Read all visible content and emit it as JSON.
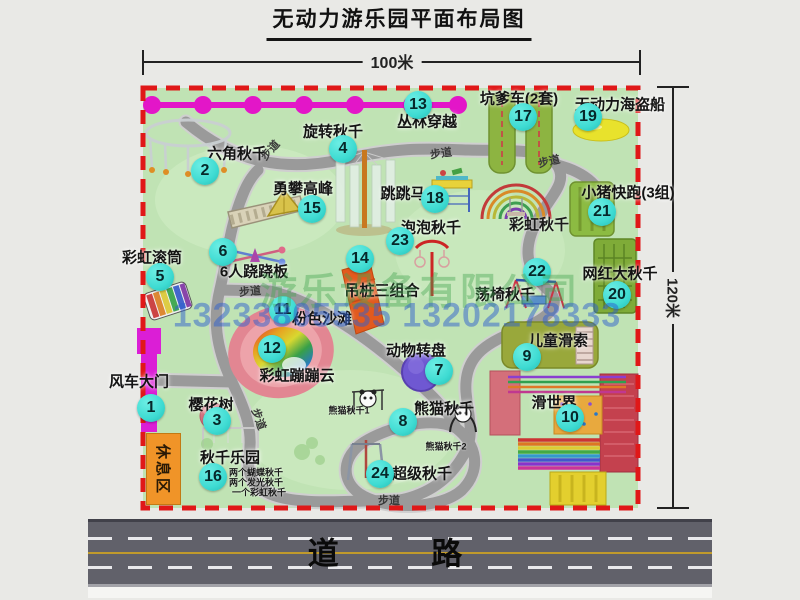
{
  "title": "无动力游乐园平面布局图",
  "dimensions": {
    "width": "100米",
    "height": "120米"
  },
  "road": {
    "label": "道 路"
  },
  "watermark": {
    "company": "游乐设备有限公司",
    "phone": "13233805535 13202178333"
  },
  "rest_area": "休息区",
  "colors": {
    "map_green": "#c0e3b4",
    "border_red": "#e01818",
    "badge_cyan": "#3edbd2",
    "chain_magenta": "#e316c8",
    "gate_magenta": "#db1ed6",
    "rest_orange": "#f09428",
    "road_gray": "#61616a",
    "path_gray": "#9a9a9a"
  },
  "attractions": [
    {
      "num": "1",
      "label": "风车大门",
      "lx": 139,
      "ly": 381,
      "bx": 151,
      "by": 408
    },
    {
      "num": "2",
      "label": "六角秋千",
      "lx": 237,
      "ly": 153,
      "bx": 205,
      "by": 171
    },
    {
      "num": "3",
      "label": "樱花树",
      "lx": 211,
      "ly": 404,
      "bx": 217,
      "by": 421
    },
    {
      "num": "4",
      "label": "旋转秋千",
      "lx": 333,
      "ly": 131,
      "bx": 343,
      "by": 149
    },
    {
      "num": "5",
      "label": "彩虹滚筒",
      "lx": 152,
      "ly": 257,
      "bx": 160,
      "by": 277
    },
    {
      "num": "6",
      "label": "6人跷跷板",
      "lx": 254,
      "ly": 271,
      "bx": 223,
      "by": 252
    },
    {
      "num": "7",
      "label": "动物转盘",
      "lx": 416,
      "ly": 350,
      "bx": 439,
      "by": 371
    },
    {
      "num": "8",
      "label": "熊猫秋千",
      "lx": 444,
      "ly": 408,
      "bx": 403,
      "by": 422
    },
    {
      "num": "9",
      "label": "儿童滑索",
      "lx": 558,
      "ly": 340,
      "bx": 527,
      "by": 357
    },
    {
      "num": "10",
      "label": "滑世界",
      "lx": 554,
      "ly": 402,
      "bx": 570,
      "by": 418
    },
    {
      "num": "11",
      "label": "粉色沙滩",
      "lx": 322,
      "ly": 318,
      "bx": 283,
      "by": 310
    },
    {
      "num": "12",
      "label": "彩虹蹦蹦云",
      "lx": 297,
      "ly": 375,
      "bx": 272,
      "by": 349
    },
    {
      "num": "13",
      "label": "丛林穿越",
      "lx": 427,
      "ly": 121,
      "bx": 418,
      "by": 105
    },
    {
      "num": "14",
      "label": "吊桩三组合",
      "lx": 382,
      "ly": 290,
      "bx": 360,
      "by": 259
    },
    {
      "num": "15",
      "label": "勇攀高峰",
      "lx": 303,
      "ly": 188,
      "bx": 312,
      "by": 209
    },
    {
      "num": "16",
      "label": "秋千乐园",
      "lx": 230,
      "ly": 457,
      "bx": 213,
      "by": 477
    },
    {
      "num": "17",
      "label": "坑爹车(2套)",
      "lx": 519,
      "ly": 98,
      "bx": 523,
      "by": 117
    },
    {
      "num": "18",
      "label": "跳跳马",
      "lx": 403,
      "ly": 193,
      "bx": 435,
      "by": 199
    },
    {
      "num": "19",
      "label": "无动力海盗船",
      "lx": 620,
      "ly": 104,
      "bx": 588,
      "by": 117
    },
    {
      "num": "20",
      "label": "网红大秋千",
      "lx": 620,
      "ly": 273,
      "bx": 617,
      "by": 295
    },
    {
      "num": "21",
      "label": "小猪快跑(3组)",
      "lx": 628,
      "ly": 192,
      "bx": 602,
      "by": 212
    },
    {
      "num": "22",
      "label": "荡椅秋千",
      "lx": 505,
      "ly": 294,
      "bx": 537,
      "by": 272
    },
    {
      "num": "23",
      "label": "泡泡秋千",
      "lx": 431,
      "ly": 227,
      "bx": 400,
      "by": 241
    },
    {
      "num": "24",
      "label": "超级秋千",
      "lx": 422,
      "ly": 473,
      "bx": 380,
      "by": 474
    }
  ],
  "small_labels": [
    {
      "text": "彩虹秋千",
      "x": 539,
      "y": 224,
      "size": 15
    },
    {
      "text": "熊猫秋千1",
      "x": 349,
      "y": 410,
      "size": 9
    },
    {
      "text": "熊猫秋千2",
      "x": 446,
      "y": 446,
      "size": 9
    },
    {
      "text": "两个蝴蝶秋千",
      "x": 256,
      "y": 472,
      "size": 9
    },
    {
      "text": "两个发光秋千",
      "x": 256,
      "y": 482,
      "size": 9
    },
    {
      "text": "一个彩虹秋千",
      "x": 259,
      "y": 492,
      "size": 9
    }
  ],
  "path_labels": [
    {
      "text": "步道",
      "x": 270,
      "y": 150,
      "rot": -48
    },
    {
      "text": "步道",
      "x": 441,
      "y": 153,
      "rot": -8
    },
    {
      "text": "步道",
      "x": 549,
      "y": 161,
      "rot": -12
    },
    {
      "text": "步道",
      "x": 250,
      "y": 291,
      "rot": -5
    },
    {
      "text": "步道",
      "x": 259,
      "y": 419,
      "rot": 70
    },
    {
      "text": "步道",
      "x": 389,
      "y": 500,
      "rot": 0
    }
  ]
}
